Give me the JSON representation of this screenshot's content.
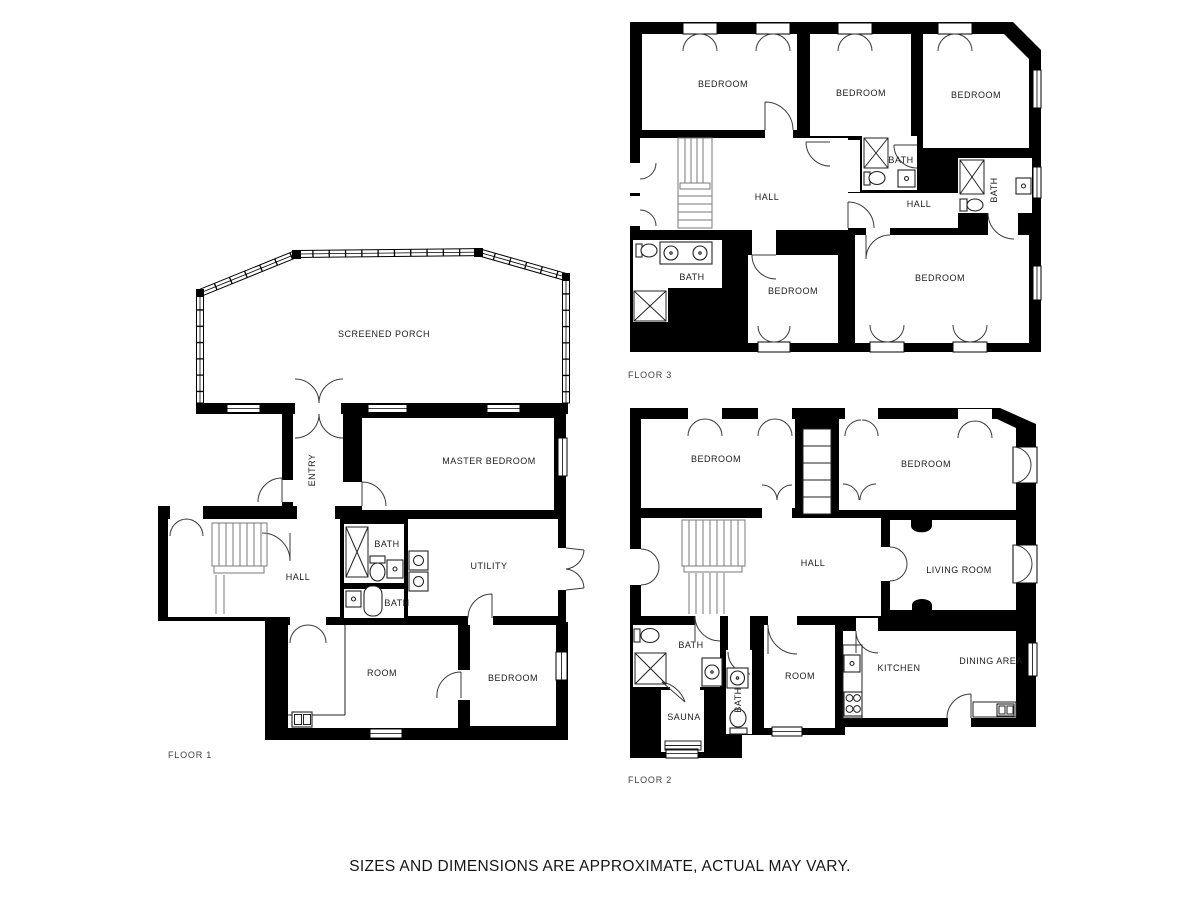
{
  "page": {
    "background": "#ffffff",
    "disclaimer": "SIZES AND DIMENSIONS ARE APPROXIMATE, ACTUAL MAY VARY."
  },
  "colors": {
    "walls": "#000000",
    "rooms": "#ffffff",
    "room_label": "#1c1c1c",
    "floor_label": "#3f3f3f",
    "disclaimer_text": "#161616"
  },
  "floors": [
    {
      "name": "FLOOR 1",
      "rooms": [
        "SCREENED PORCH",
        "ENTRY",
        "MASTER BEDROOM",
        "HALL",
        "BATH",
        "BATH",
        "UTILITY",
        "ROOM",
        "BEDROOM"
      ]
    },
    {
      "name": "FLOOR 2",
      "rooms": [
        "BEDROOM",
        "BEDROOM",
        "HALL",
        "LIVING ROOM",
        "BATH",
        "SAUNA",
        "BATH",
        "ROOM",
        "KITCHEN",
        "DINING AREA"
      ]
    },
    {
      "name": "FLOOR 3",
      "rooms": [
        "BEDROOM",
        "BEDROOM",
        "BEDROOM",
        "HALL",
        "BATH",
        "HALL",
        "BATH",
        "BATH",
        "BEDROOM",
        "BEDROOM"
      ]
    }
  ]
}
